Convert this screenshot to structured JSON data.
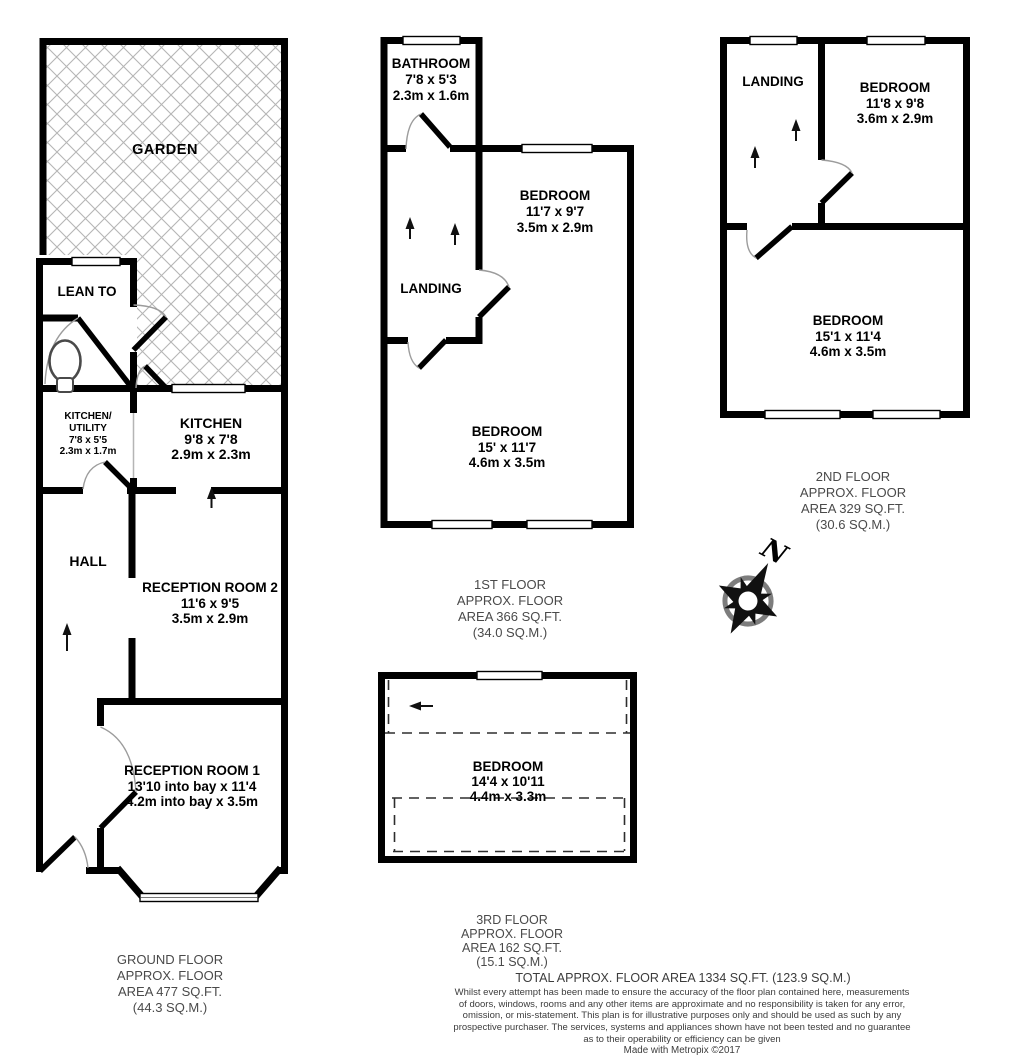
{
  "rooms": {
    "garden": {
      "lines": [
        "GARDEN"
      ]
    },
    "lean_to": {
      "lines": [
        "LEAN TO"
      ]
    },
    "kitchen_utility": {
      "lines": [
        "KITCHEN/",
        "UTILITY",
        "7'8 x 5'5",
        "2.3m x 1.7m"
      ]
    },
    "kitchen": {
      "lines": [
        "KITCHEN",
        "9'8 x 7'8",
        "2.9m x 2.3m"
      ]
    },
    "hall": {
      "lines": [
        "HALL"
      ]
    },
    "reception_room_2": {
      "lines": [
        "RECEPTION ROOM 2",
        "11'6 x 9'5",
        "3.5m x 2.9m"
      ]
    },
    "reception_room_1": {
      "lines": [
        "RECEPTION ROOM 1",
        "13'10 into bay x 11'4",
        "4.2m into bay x 3.5m"
      ]
    },
    "bathroom": {
      "lines": [
        "BATHROOM",
        "7'8 x 5'3",
        "2.3m x 1.6m"
      ]
    },
    "first_floor_bedroom_front": {
      "lines": [
        "BEDROOM",
        "11'7 x 9'7",
        "3.5m x 2.9m"
      ]
    },
    "first_floor_landing": {
      "lines": [
        "LANDING"
      ]
    },
    "first_floor_bedroom_rear": {
      "lines": [
        "BEDROOM",
        "15' x 11'7",
        "4.6m x 3.5m"
      ]
    },
    "second_floor_landing": {
      "lines": [
        "LANDING"
      ]
    },
    "second_floor_bedroom_front": {
      "lines": [
        "BEDROOM",
        "11'8 x 9'8",
        "3.6m x 2.9m"
      ]
    },
    "second_floor_bedroom_rear": {
      "lines": [
        "BEDROOM",
        "15'1 x 11'4",
        "4.6m x 3.5m"
      ]
    },
    "third_floor_bedroom": {
      "lines": [
        "BEDROOM",
        "14'4 x 10'11",
        "4.4m x 3.3m"
      ]
    }
  },
  "floor_labels": {
    "ground": {
      "lines": [
        "GROUND FLOOR",
        "APPROX. FLOOR",
        "AREA 477 SQ.FT.",
        "(44.3 SQ.M.)"
      ]
    },
    "first": {
      "lines": [
        "1ST FLOOR",
        "APPROX. FLOOR",
        "AREA 366 SQ.FT.",
        "(34.0 SQ.M.)"
      ]
    },
    "second": {
      "lines": [
        "2ND FLOOR",
        "APPROX. FLOOR",
        "AREA 329 SQ.FT.",
        "(30.6 SQ.M.)"
      ]
    },
    "third": {
      "lines": [
        "3RD FLOOR",
        "APPROX. FLOOR",
        "AREA 162 SQ.FT.",
        "(15.1 SQ.M.)"
      ]
    }
  },
  "footer": {
    "total": "TOTAL APPROX. FLOOR AREA 1334 SQ.FT. (123.9 SQ.M.)",
    "disclaimer_lines": [
      "Whilst every attempt has been made to ensure the accuracy of the floor plan contained here, measurements",
      "of doors, windows, rooms and any other items are approximate and no responsibility is taken for any error,",
      "omission, or mis-statement. This plan is for illustrative purposes only and should be used as such by any",
      "prospective purchaser. The services, systems and appliances shown have not been tested and no guarantee",
      "as to their operability or efficiency can be given"
    ],
    "credit": "Made with Metropix ©2017"
  },
  "compass": {
    "north_label": "N"
  },
  "colors": {
    "wall": "#000000",
    "garden_hatch": "#b5b5b5",
    "door_arc": "#9c9c9c",
    "floor_label_text": "#4a4a4a",
    "footer_text": "#3c3c3c"
  }
}
